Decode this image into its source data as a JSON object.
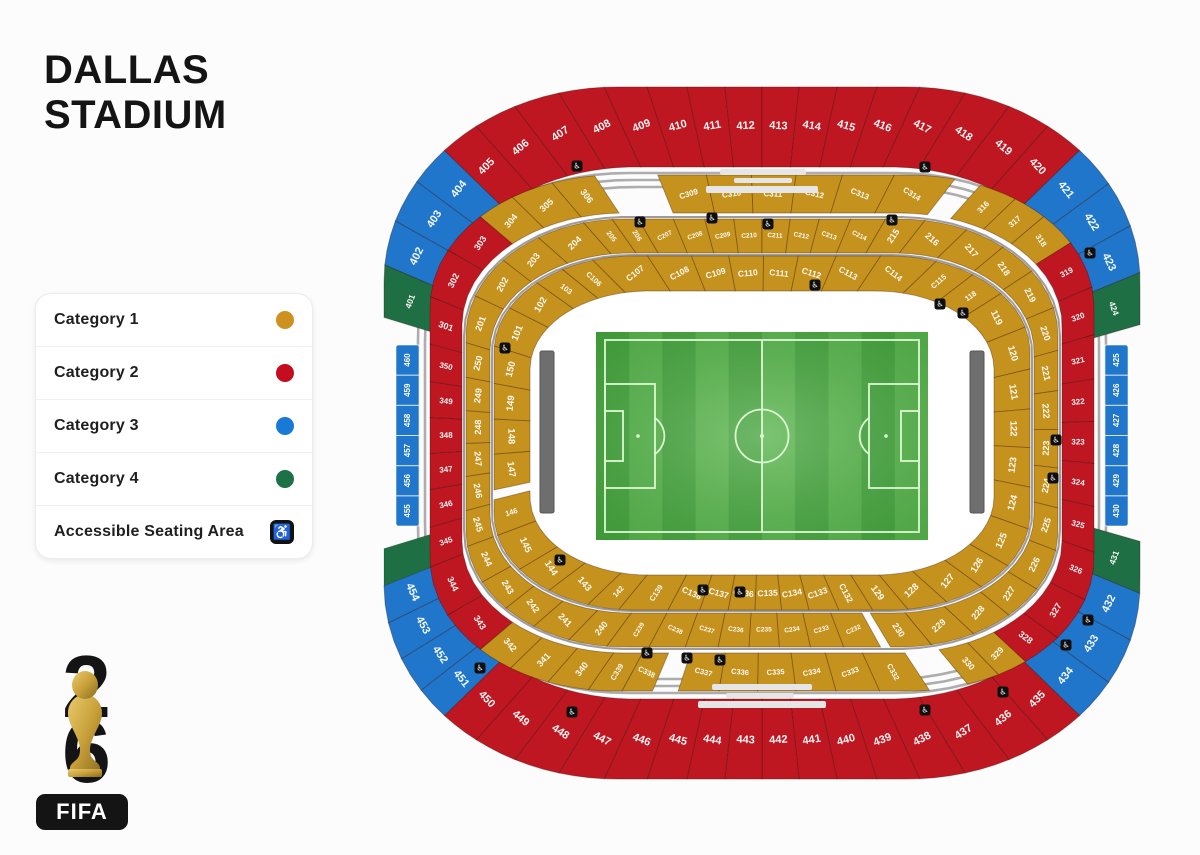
{
  "title": {
    "line1": "DALLAS",
    "line2": "STADIUM"
  },
  "legend": {
    "items": [
      {
        "label": "Category 1",
        "type": "dot",
        "color": "#CE9120"
      },
      {
        "label": "Category 2",
        "type": "dot",
        "color": "#C40D1E"
      },
      {
        "label": "Category 3",
        "type": "dot",
        "color": "#1879D8"
      },
      {
        "label": "Category 4",
        "type": "dot",
        "color": "#1D7147"
      },
      {
        "label": "Accessible Seating Area",
        "type": "icon",
        "icon": "wheelchair-icon",
        "glyph": "♿"
      }
    ]
  },
  "logo": {
    "top_digit": "2",
    "bottom_digit": "6",
    "brand": "FIFA"
  },
  "stadium": {
    "cx": 762,
    "cy": 433,
    "colors": {
      "gold": "#C6921E",
      "red": "#BE1722",
      "blue": "#2076CB",
      "green": "#1F6F44",
      "gray": "#ADADAD",
      "divider": "rgba(50,15,5,0.35)",
      "suite": "#6e6e6e",
      "pitch1": "#46a43e",
      "pitch2": "#58b44c",
      "pitchLine": "#dcf8d2"
    },
    "grayRings": [
      {
        "W": 330,
        "H": 246,
        "Rx": 200,
        "Ry": 150
      },
      {
        "W": 337,
        "H": 253,
        "Rx": 204,
        "Ry": 154
      },
      {
        "W": 344,
        "H": 260,
        "Rx": 208,
        "Ry": 158
      },
      {
        "W": 298,
        "H": 216,
        "Rx": 162,
        "Ry": 118
      },
      {
        "W": 270,
        "H": 178,
        "Rx": 140,
        "Ry": 97
      }
    ],
    "rings": [
      {
        "id": "ring-400-top",
        "fs": 11,
        "out": {
          "W": 378,
          "H": 346,
          "Rx": 232,
          "Ry": 194
        },
        "in": {
          "W": 324,
          "H": 266,
          "Rx": 196,
          "Ry": 152
        },
        "lab": {
          "W": 352,
          "H": 307,
          "Rx": 214,
          "Ry": 174
        },
        "groups": [
          {
            "c": "green",
            "a": [
              -163,
              -156
            ],
            "fs": 8.5,
            "labels": [
              "401"
            ]
          },
          {
            "c": "blue",
            "a": [
              -156,
              -139
            ],
            "labels": [
              "402",
              "403",
              "404"
            ]
          },
          {
            "c": "red",
            "a": [
              -139,
              -41
            ],
            "labels": [
              "405",
              "406",
              "407",
              "408",
              "409",
              "410",
              "411",
              "412",
              "413",
              "414",
              "415",
              "416",
              "417",
              "418",
              "419",
              "420"
            ]
          },
          {
            "c": "blue",
            "a": [
              -41,
              -23
            ],
            "labels": [
              "421",
              "422",
              "423"
            ]
          },
          {
            "c": "green",
            "a": [
              -23,
              -16
            ],
            "fs": 8.5,
            "labels": [
              "424"
            ]
          }
        ]
      },
      {
        "id": "ring-400-bottom",
        "fs": 11,
        "out": {
          "W": 378,
          "H": 346,
          "Rx": 232,
          "Ry": 194
        },
        "in": {
          "W": 324,
          "H": 266,
          "Rx": 196,
          "Ry": 152
        },
        "lab": {
          "W": 352,
          "H": 307,
          "Rx": 214,
          "Ry": 174
        },
        "groups": [
          {
            "c": "green",
            "a": [
              16,
              23
            ],
            "fs": 8.5,
            "labels": [
              "431"
            ]
          },
          {
            "c": "blue",
            "a": [
              23,
              41
            ],
            "labels": [
              "432",
              "433",
              "434"
            ]
          },
          {
            "c": "red",
            "a": [
              41,
              139
            ],
            "labels": [
              "435",
              "436",
              "437",
              "438",
              "439",
              "440",
              "441",
              "442",
              "443",
              "444",
              "445",
              "446",
              "447",
              "448",
              "449",
              "450"
            ]
          },
          {
            "c": "blue",
            "a": [
              139,
              158
            ],
            "labels": [
              "451",
              "452",
              "453",
              "454"
            ]
          },
          {
            "c": "green",
            "a": [
              158,
              163
            ],
            "labels": []
          }
        ]
      },
      {
        "id": "ring-300",
        "fs": 9,
        "out": {
          "W": 332,
          "H": 258,
          "Rx": 185,
          "Ry": 132
        },
        "in": {
          "W": 300,
          "H": 220,
          "Rx": 162,
          "Ry": 112
        },
        "lab": {
          "W": 316,
          "H": 239,
          "Rx": 173,
          "Ry": 122
        },
        "groups": [
          {
            "c": "red",
            "a": [
              158,
              195
            ],
            "fs": 8,
            "labels": [
              "345*",
              "346*",
              "347*",
              "348*",
              "349*",
              "350*"
            ]
          },
          {
            "c": "red",
            "a": [
              195,
              217
            ],
            "labels": [
              "301*",
              "302",
              "303"
            ]
          },
          {
            "c": "gold",
            "a": [
              217,
              237
            ],
            "labels": [
              "304",
              "305",
              "306*"
            ]
          },
          {
            "c": "gold",
            "a": [
              248,
              307
            ],
            "fs": 8,
            "labels": [
              "C309",
              "C310",
              "C311",
              "C312",
              "C313",
              "C314"
            ]
          },
          {
            "c": "gold",
            "a": [
              311,
              329
            ],
            "fs": 8,
            "labels": [
              "316*",
              "317*",
              "318"
            ]
          },
          {
            "c": "red",
            "a": [
              329,
              387
            ],
            "fs": 8,
            "labels": [
              "319*",
              "320*",
              "321*",
              "322*",
              "323*",
              "324*",
              "325*",
              "326*"
            ]
          },
          {
            "c": "red",
            "a": [
              387,
              401
            ],
            "labels": [
              "327",
              "328*"
            ]
          },
          {
            "c": "gold",
            "a": [
              401,
              411
            ],
            "fs": 8.5,
            "labels": [
              "329",
              "330*"
            ]
          },
          {
            "c": "gold",
            "a": [
              417,
              468
            ],
            "fs": 7.5,
            "labels": [
              "C332*",
              "C333",
              "C334",
              "C335",
              "C336",
              "C337"
            ]
          },
          {
            "c": "gold",
            "a": [
              473,
              484
            ],
            "fs": 7.5,
            "labels": [
              "C338",
              "C339*"
            ]
          },
          {
            "c": "gold",
            "a": [
              484,
              503
            ],
            "labels": [
              "340*",
              "341*",
              "342"
            ]
          },
          {
            "c": "red",
            "a": [
              503,
              518
            ],
            "labels": [
              "343",
              "344"
            ]
          }
        ]
      },
      {
        "id": "ring-200",
        "fs": 9,
        "out": {
          "W": 296,
          "H": 214,
          "Rx": 158,
          "Ry": 116
        },
        "in": {
          "W": 272,
          "H": 180,
          "Rx": 140,
          "Ry": 98
        },
        "lab": {
          "W": 284,
          "H": 197,
          "Rx": 150,
          "Ry": 107
        },
        "groups": [
          {
            "c": "gold",
            "a": [
              159,
              197
            ],
            "labels": [
              "245",
              "246",
              "247",
              "248",
              "249",
              "250"
            ]
          },
          {
            "c": "gold",
            "a": [
              197,
              230
            ],
            "labels": [
              "201",
              "202",
              "203",
              "204"
            ]
          },
          {
            "c": "gold",
            "a": [
              230,
              240
            ],
            "fs": 7,
            "labels": [
              "205*",
              "206*"
            ]
          },
          {
            "c": "gold",
            "a": [
              240,
              300
            ],
            "fs": 6.5,
            "labels": [
              "C207",
              "C208",
              "C209",
              "C210",
              "C211",
              "C212",
              "C213",
              "C214"
            ]
          },
          {
            "c": "gold",
            "a": [
              300,
              322
            ],
            "labels": [
              "215*",
              "216",
              "217"
            ]
          },
          {
            "c": "gold",
            "a": [
              322,
              419
            ],
            "labels": [
              "218",
              "219",
              "220",
              "221",
              "222",
              "223",
              "224",
              "225",
              "226",
              "227",
              "228",
              "229",
              "230*"
            ]
          },
          {
            "c": "gold",
            "a": [
              421,
              486
            ],
            "fs": 6.5,
            "labels": [
              "C232",
              "C233",
              "C234",
              "C235",
              "C236",
              "C237",
              "C238",
              "C239*"
            ]
          },
          {
            "c": "gold",
            "a": [
              486,
              519
            ],
            "labels": [
              "240*",
              "241",
              "242",
              "243",
              "244"
            ]
          }
        ]
      },
      {
        "id": "ring-100",
        "fs": 9.5,
        "out": {
          "W": 268,
          "H": 177,
          "Rx": 140,
          "Ry": 96
        },
        "in": {
          "W": 232,
          "H": 142,
          "Rx": 118,
          "Ry": 78
        },
        "lab": {
          "W": 251,
          "H": 160,
          "Rx": 130,
          "Ry": 88
        },
        "groups": [
          {
            "c": "gold",
            "a": [
              168,
              198
            ],
            "labels": [
              "147",
              "148",
              "149",
              "150"
            ]
          },
          {
            "c": "gold",
            "a": [
              198,
              214
            ],
            "labels": [
              "101",
              "102"
            ]
          },
          {
            "c": "gold",
            "a": [
              214,
              226
            ],
            "fs": 7.5,
            "labels": [
              "103*",
              "C106*"
            ]
          },
          {
            "c": "gold",
            "a": [
              226,
              315
            ],
            "fs": 8.5,
            "labels": [
              "C107",
              "C108",
              "C109",
              "C110",
              "C111",
              "C112",
              "C113",
              "C114"
            ]
          },
          {
            "c": "gold",
            "a": [
              315,
              330
            ],
            "fs": 7.5,
            "labels": [
              "C115*",
              "118*"
            ]
          },
          {
            "c": "gold",
            "a": [
              330,
              388
            ],
            "labels": [
              "119",
              "120",
              "121",
              "122",
              "123",
              "124",
              "125"
            ]
          },
          {
            "c": "gold",
            "a": [
              388,
              418
            ],
            "labels": [
              "126",
              "127",
              "128",
              "129*"
            ]
          },
          {
            "c": "gold",
            "a": [
              418,
              478
            ],
            "fs": 8.5,
            "labels": [
              "C132*",
              "C133",
              "C134",
              "C135",
              "C136",
              "C137",
              "C138"
            ]
          },
          {
            "c": "gold",
            "a": [
              478,
              489
            ],
            "fs": 7.5,
            "labels": [
              "C139*"
            ]
          },
          {
            "c": "gold",
            "a": [
              489,
              495
            ],
            "fs": 7.5,
            "labels": [
              "142*"
            ]
          },
          {
            "c": "gold",
            "a": [
              495,
              519
            ],
            "labels": [
              "143",
              "144",
              "145"
            ]
          },
          {
            "c": "gold",
            "a": [
              519,
              526
            ],
            "fs": 7.5,
            "labels": [
              "146*"
            ]
          }
        ]
      }
    ],
    "strips": [
      {
        "id": "strip-west",
        "x": 396,
        "y": 345,
        "w": 23,
        "h": 181,
        "labels": [
          "460",
          "459",
          "458",
          "457",
          "456",
          "455"
        ]
      },
      {
        "id": "strip-east",
        "x": 1105,
        "y": 345,
        "w": 23,
        "h": 181,
        "labels": [
          "425",
          "426",
          "427",
          "428",
          "429",
          "430"
        ]
      }
    ],
    "suites": [
      {
        "id": "suite-bar-west",
        "x": 540,
        "y": 351,
        "w": 14,
        "h": 162
      },
      {
        "id": "suite-bar-east",
        "x": 970,
        "y": 351,
        "w": 14,
        "h": 162
      }
    ],
    "bowl": {
      "W": 234,
      "H": 144,
      "Rx": 118,
      "Ry": 80
    },
    "pitch": {
      "x": 596,
      "y": 332,
      "w": 332,
      "h": 208,
      "stripes": 10
    },
    "pills": [
      [
        720,
        169,
        86,
        6
      ],
      [
        734,
        178,
        58,
        5
      ],
      [
        706,
        186,
        112,
        7
      ],
      [
        712,
        684,
        100,
        6
      ],
      [
        726,
        693,
        68,
        5
      ],
      [
        698,
        701,
        128,
        7
      ]
    ],
    "icons": [
      [
        577,
        166
      ],
      [
        925,
        167
      ],
      [
        1090,
        253
      ],
      [
        640,
        222
      ],
      [
        712,
        218
      ],
      [
        768,
        224
      ],
      [
        892,
        220
      ],
      [
        815,
        285
      ],
      [
        940,
        304
      ],
      [
        963,
        313
      ],
      [
        505,
        348
      ],
      [
        560,
        560
      ],
      [
        1056,
        440
      ],
      [
        1053,
        478
      ],
      [
        480,
        668
      ],
      [
        703,
        590
      ],
      [
        740,
        592
      ],
      [
        647,
        653
      ],
      [
        687,
        658
      ],
      [
        720,
        660
      ],
      [
        572,
        712
      ],
      [
        925,
        710
      ],
      [
        1003,
        692
      ],
      [
        1088,
        620
      ],
      [
        1066,
        645
      ]
    ],
    "accessible_glyph": "♿"
  }
}
